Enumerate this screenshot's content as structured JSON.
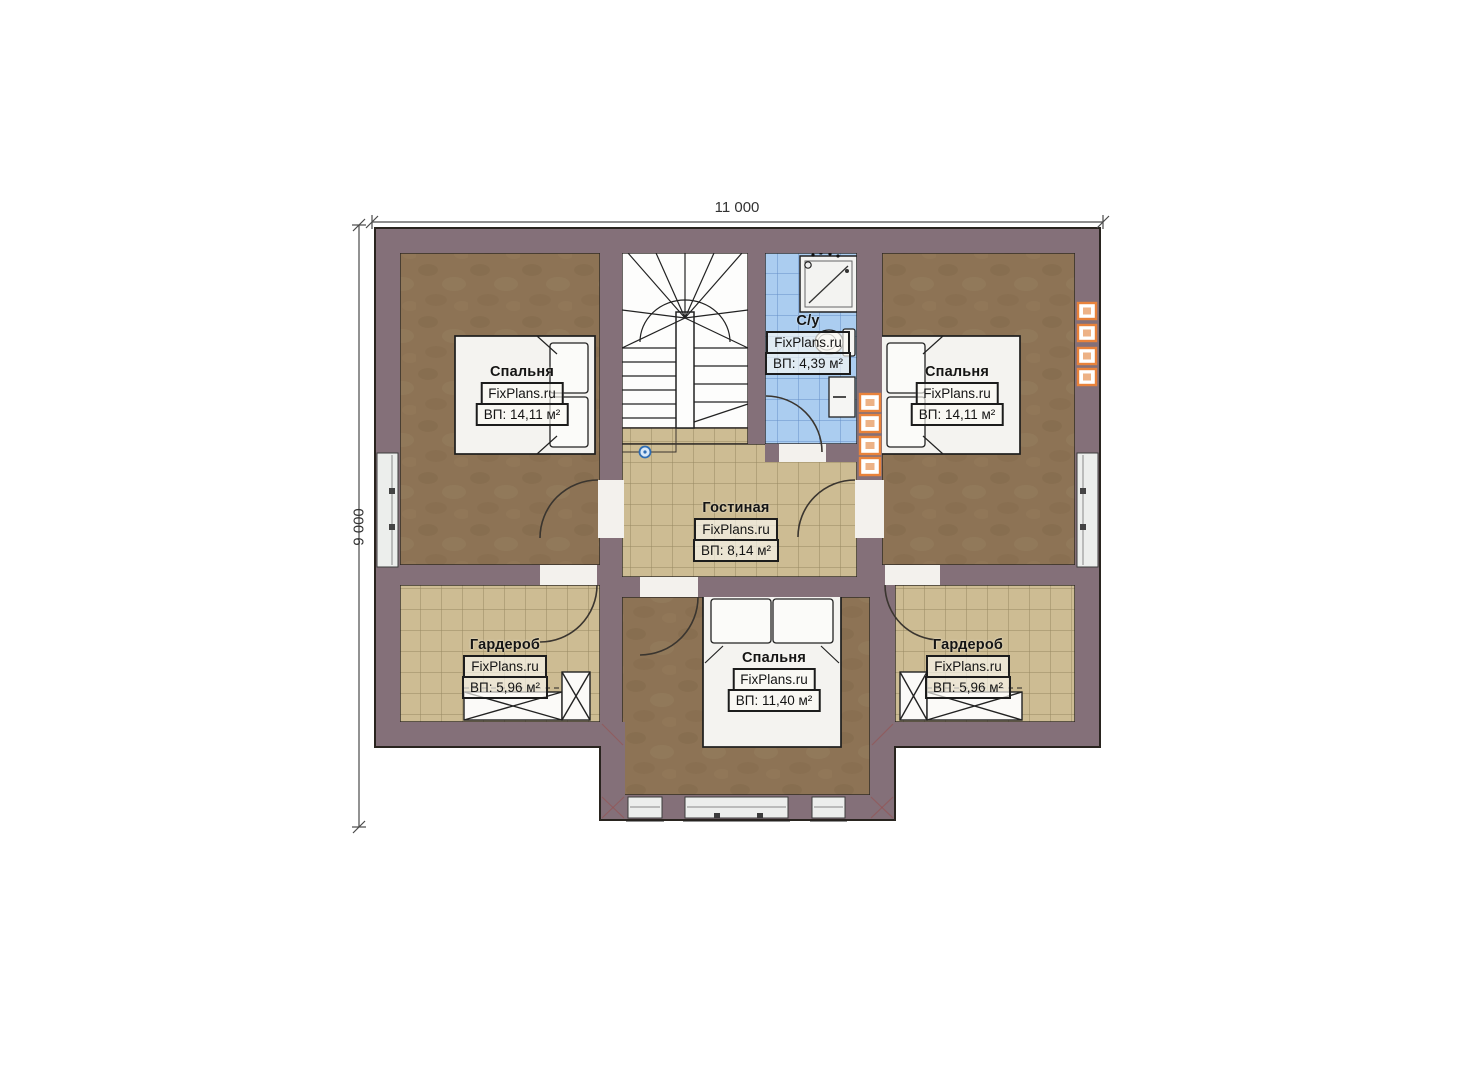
{
  "dimensions": {
    "width_label": "11 000",
    "height_label": "9 000"
  },
  "rooms": [
    {
      "id": "bedroom-left",
      "name": "Спальня",
      "brand": "FixPlans.ru",
      "area": "ВП: 14,11 м²"
    },
    {
      "id": "bathroom",
      "name": "С/у",
      "brand": "FixPlans.ru",
      "area": "ВП: 4,39 м²"
    },
    {
      "id": "bedroom-right",
      "name": "Спальня",
      "brand": "FixPlans.ru",
      "area": "ВП: 14,11 м²"
    },
    {
      "id": "living-room",
      "name": "Гостиная",
      "brand": "FixPlans.ru",
      "area": "ВП: 8,14 м²"
    },
    {
      "id": "wardrobe-left",
      "name": "Гардероб",
      "brand": "FixPlans.ru",
      "area": "ВП: 5,96 м²"
    },
    {
      "id": "bedroom-bottom",
      "name": "Спальня",
      "brand": "FixPlans.ru",
      "area": "ВП: 11,40 м²"
    },
    {
      "id": "wardrobe-right",
      "name": "Гардероб",
      "brand": "FixPlans.ru",
      "area": "ВП: 5,96 м²"
    }
  ],
  "colors": {
    "wall": "#847079",
    "floor_wood": "#8d7355",
    "floor_tile_beige": "#cdbc93",
    "floor_tile_blue": "#abcdf0",
    "vent_orange": "#e8823b",
    "marker_blue": "#2e6db4"
  }
}
